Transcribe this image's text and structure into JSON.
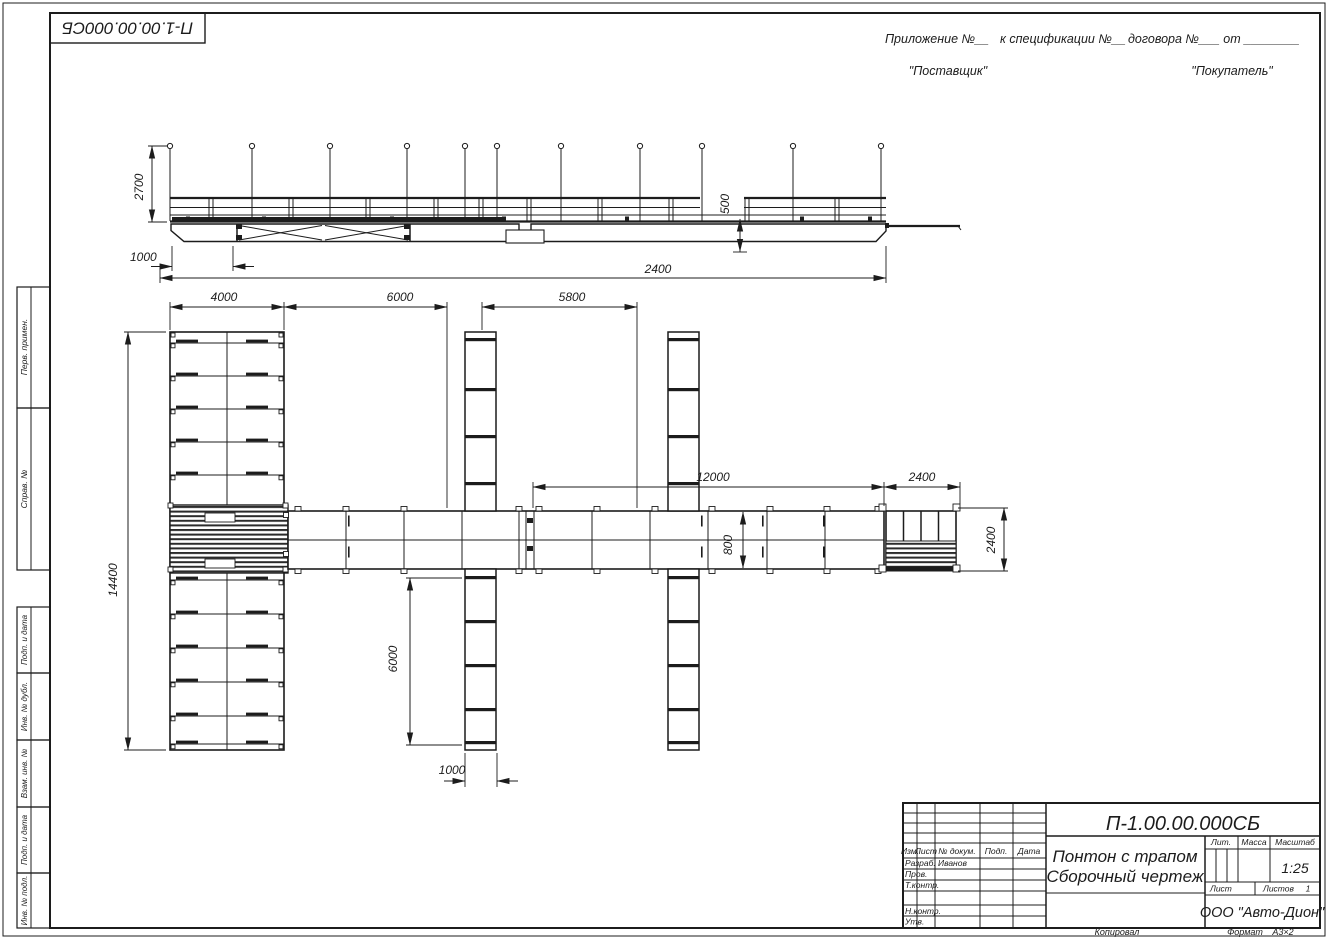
{
  "sheet": {
    "doc_code_top": "П-1.00.00.000СБ",
    "stamp_top": [
      "Перв. примен.",
      "Справ. №"
    ],
    "stamp_bottom": [
      "Подп. и дата",
      "Инв. № дубл.",
      "Взам. инв. №",
      "Подп. и дата",
      "Инв. № подл."
    ],
    "footer": {
      "copied": "Копировал",
      "format_label": "Формат",
      "format_value": "А3×2"
    }
  },
  "header": {
    "appendix": "Приложение №__",
    "spec": "к спецификации №__",
    "contract": "договора №___ от ________",
    "supplier": "\"Поставщик\"",
    "buyer": "\"Покупатель\""
  },
  "title_block": {
    "code": "П-1.00.00.000СБ",
    "col_izm": "Изм.",
    "col_list": "Лист",
    "col_doc": "№ докум.",
    "col_podp": "Подп.",
    "col_data": "Дата",
    "row_razrab": "Разраб.",
    "row_prov": "Пров.",
    "row_tkontr": "Т.контр.",
    "row_nkontr": "Н.контр.",
    "row_utv": "Утв.",
    "developer": "Иванов",
    "title1": "Понтон с трапом",
    "title2": "Сборочный чертеж",
    "lit": "Лит.",
    "mass": "Масса",
    "scale_label": "Масштаб",
    "scale": "1:25",
    "sheet_label": "Лист",
    "sheets_label": "Листов",
    "sheets_value": "1",
    "company": "ООО \"Авто-Дион\""
  },
  "dims": {
    "side_height": "2700",
    "side_offset": "1000",
    "side_freeboard": "500",
    "side_length": "2400",
    "plan_block_w": "4000",
    "plan_bay1": "6000",
    "plan_bay2": "5800",
    "plan_walkway_len": "12000",
    "plan_end_w": "2400",
    "plan_block_h": "14400",
    "plan_walkway_w": "800",
    "plan_pier_len": "6000",
    "plan_pier_w": "1000",
    "plan_end_h": "2400"
  }
}
